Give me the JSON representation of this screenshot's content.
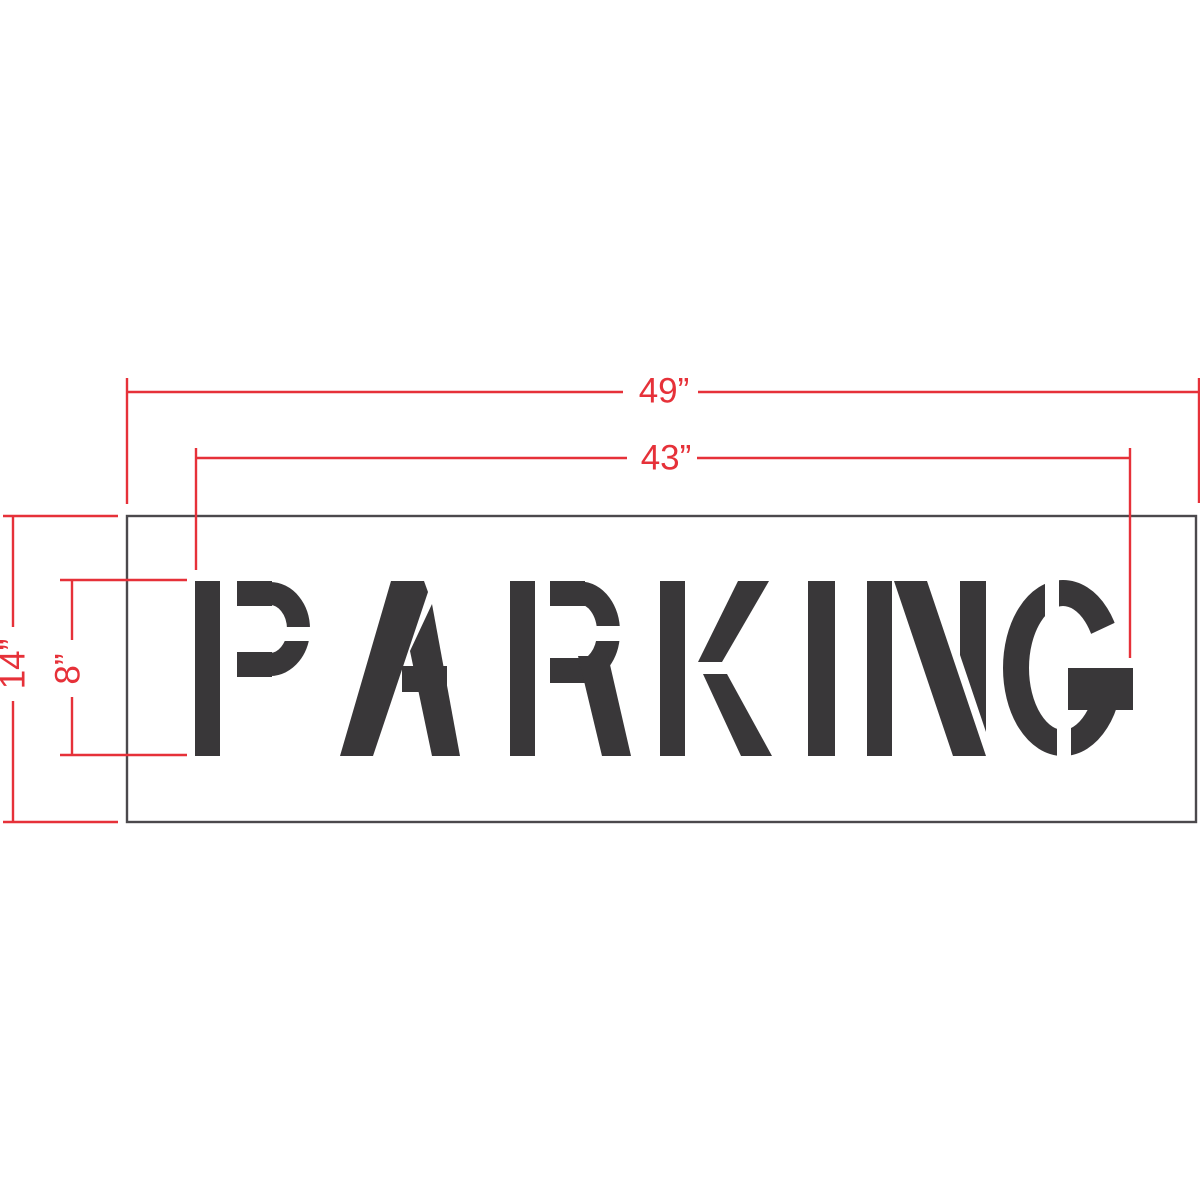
{
  "diagram": {
    "stencil_text": "PARKING",
    "dimensions": {
      "overall_width_label": "49”",
      "text_width_label": "43”",
      "overall_height_label": "14”",
      "letter_height_label": "8”"
    },
    "colors": {
      "dimension_red": "#e63139",
      "stencil_ink": "#393739",
      "outline_gray": "#4b494c",
      "background": "#ffffff"
    }
  }
}
